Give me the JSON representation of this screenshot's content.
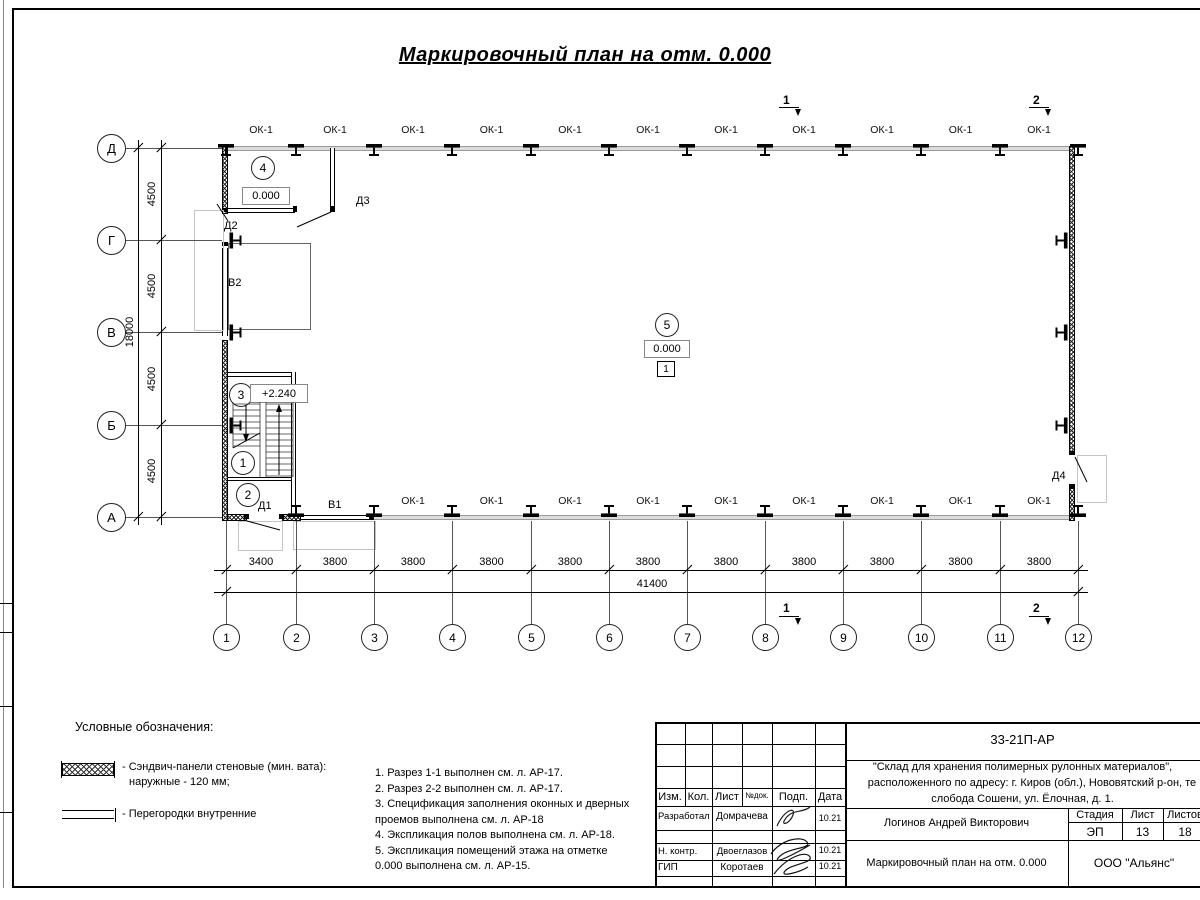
{
  "sheet": {
    "title": "Маркировочный план на отм. 0.000"
  },
  "plan": {
    "window_label": "ОК-1",
    "col_axes": [
      "1",
      "2",
      "3",
      "4",
      "5",
      "6",
      "7",
      "8",
      "9",
      "10",
      "11",
      "12"
    ],
    "row_axes": [
      "Д",
      "Г",
      "В",
      "Б",
      "А"
    ],
    "bottom_dims": [
      "3400",
      "3800",
      "3800",
      "3800",
      "3800",
      "3800",
      "3800",
      "3800",
      "3800",
      "3800",
      "3800"
    ],
    "bottom_total": "41400",
    "left_dims": [
      "4500",
      "4500",
      "4500",
      "4500"
    ],
    "left_total": "18000",
    "rooms": {
      "room4_num": "4",
      "room4_elev": "0.000",
      "room3_num": "3",
      "room3_elev": "+2.240",
      "room1_num": "1",
      "room2_num": "2",
      "room5_num": "5",
      "room5_elev": "0.000",
      "room5_floor_type": "1"
    },
    "doors": {
      "d1": "Д1",
      "d2": "Д2",
      "d3": "Д3",
      "d4": "Д4"
    },
    "gates": {
      "v1": "В1",
      "v2": "В2"
    },
    "section_marks": {
      "s1": "1",
      "s2": "2"
    }
  },
  "legend": {
    "heading": "Условные обозначения:",
    "item1_line1": "- Сэндвич-панели стеновые (мин. вата):",
    "item1_line2": "наружные - 120 мм;",
    "item2_line1": "- Перегородки внутренние"
  },
  "notes": [
    "1. Разрез 1-1 выполнен см. л. АР-17.",
    "2. Разрез 2-2 выполнен см. л. АР-17.",
    "3. Спецификация заполнения оконных и дверных",
    "проемов выполнена см. л. АР-18",
    "4. Экспликация полов выполнена см. л. АР-18.",
    "5. Экспликация помещений этажа на отметке",
    "0.000 выполнена см. л. АР-15."
  ],
  "titleblock": {
    "doc_number": "33-21П-АР",
    "project_line1": "\"Склад для хранения полимерных рулонных материалов\",",
    "project_line2": "расположенного по адресу: г. Киров (обл.), Нововятский р-он, те",
    "project_line3": "слобода Сошени, ул. Ёлочная, д. 1.",
    "header_cols": [
      "Изм.",
      "Кол.",
      "Лист",
      "№док.",
      "Подп.",
      "Дата"
    ],
    "sign_rows": [
      {
        "role": "Разработал",
        "name": "Домрачева",
        "date": "10.21"
      },
      {
        "role": "Н. контр.",
        "name": "Двоеглазов",
        "date": "10.21"
      },
      {
        "role": "ГИП",
        "name": "Коротаев",
        "date": "10.21"
      }
    ],
    "chief_name": "Логинов Андрей Викторович",
    "stage_label": "Стадия",
    "sheet_label": "Лист",
    "sheets_label": "Листов",
    "stage_value": "ЭП",
    "sheet_value": "13",
    "sheets_value": "18",
    "drawing_name": "Маркировочный план на отм. 0.000",
    "company": "ООО \"Альянс\""
  }
}
